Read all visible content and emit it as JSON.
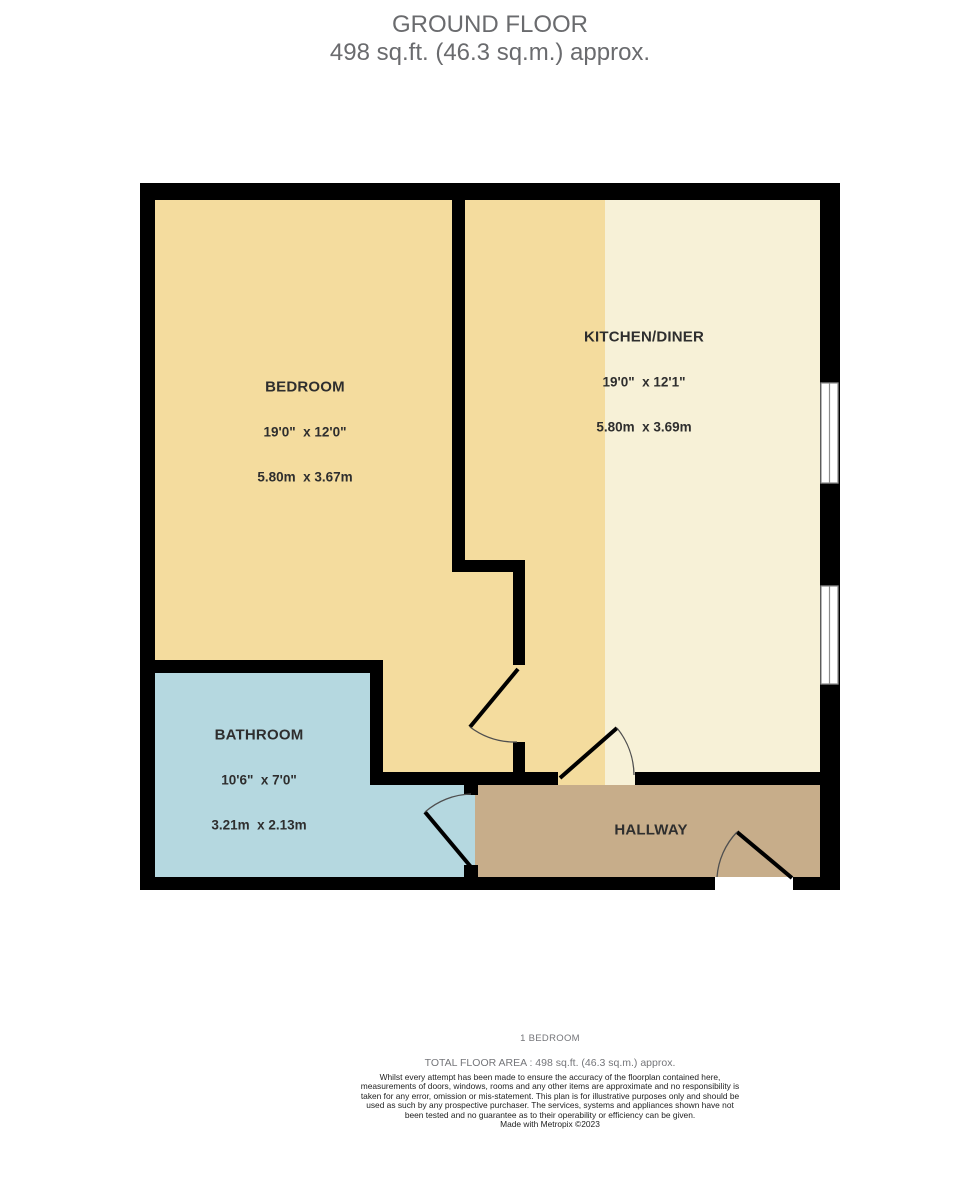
{
  "title": {
    "line1": "GROUND FLOOR",
    "line2": "498 sq.ft. (46.3 sq.m.) approx."
  },
  "rooms": {
    "bedroom": {
      "name": "BEDROOM",
      "imperial": "19'0\"  x 12'0\"",
      "metric": "5.80m  x 3.67m"
    },
    "kitchen": {
      "name": "KITCHEN/DINER",
      "imperial": "19'0\"  x 12'1\"",
      "metric": "5.80m  x 3.69m"
    },
    "bathroom": {
      "name": "BATHROOM",
      "imperial": "10'6\"  x 7'0\"",
      "metric": "3.21m  x 2.13m"
    },
    "hallway": {
      "name": "HALLWAY"
    }
  },
  "footer": {
    "bedroom_count": "1 BEDROOM",
    "total_area": "TOTAL FLOOR AREA : 498 sq.ft. (46.3 sq.m.) approx.",
    "disclaimer": "Whilst every attempt has been made to ensure the accuracy of the floorplan contained here, measurements of doors, windows, rooms and any other items are approximate and no responsibility is taken for any error, omission or mis-statement. This plan is for illustrative purposes only and should be used as such by any prospective purchaser. The services, systems and appliances shown have not been tested and no guarantee as to their operability or efficiency can be given.",
    "credit": "Made with Metropix ©2023"
  },
  "colors": {
    "bedroom": "#F4DC9E",
    "kitchen": "#F7F1D7",
    "bathroom": "#B5D8E0",
    "hallway": "#C7AD8A",
    "wall": "#000000",
    "title_text": "#6A6B6E",
    "muted_text": "#75767A",
    "label_text": "#2E2E2E"
  }
}
